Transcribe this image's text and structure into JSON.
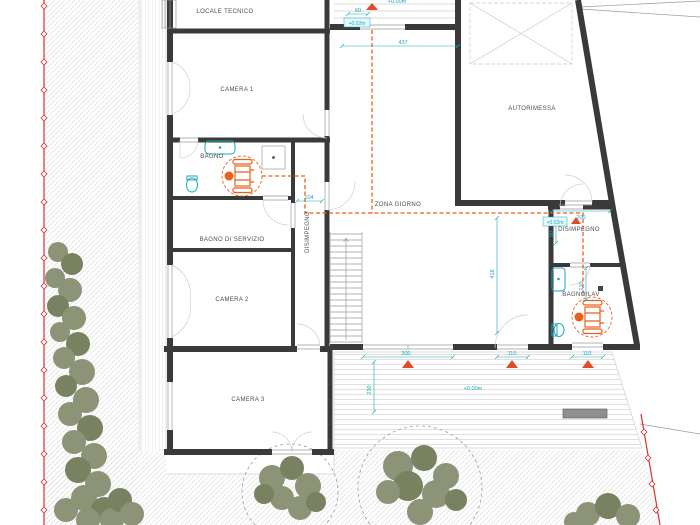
{
  "rooms": {
    "locale_tecnico": "LOCALE TECNICO",
    "camera_1": "CAMERA 1",
    "bagno": "BAGNO",
    "bagno_di_servizio": "BAGNO DI SERVIZIO",
    "camera_2": "CAMERA 2",
    "camera_3": "CAMERA 3",
    "disimpegno_hall": "DISIMPEGNO",
    "zona_giorno": "ZONA GIORNO",
    "autorimessa": "AUTORIMESSA",
    "disimpegno": "DISIMPEGNO",
    "bagno_lav": "BAGNO/LAV"
  },
  "levels": {
    "top": "+0.00m",
    "entry": "+0.02m",
    "landing": "+0.02m",
    "terrace": "+0.00m"
  },
  "dimensions": {
    "entry_door": "60",
    "living_width": "437",
    "hall_opening": "104",
    "living_depth": "418",
    "garage_opening": "200",
    "disimpegno_width": "50",
    "bagno_lav_width": "120",
    "terrace_door": "300",
    "terrace_window_1": "110",
    "terrace_window_2": "110",
    "terrace_depth": "230"
  },
  "colors": {
    "wall": "#3a3a3a",
    "dimension": "#18a8c0",
    "accessibility": "#e8611a",
    "boundary": "#d9312f",
    "vegetation": "#8c9377",
    "vegetation_dark": "#798260",
    "hatch": "#dedede",
    "deck_line": "#d8d8d8",
    "thin_line": "#9b9b9b",
    "label": "#4d4d4d",
    "marker": "#e04b28"
  }
}
